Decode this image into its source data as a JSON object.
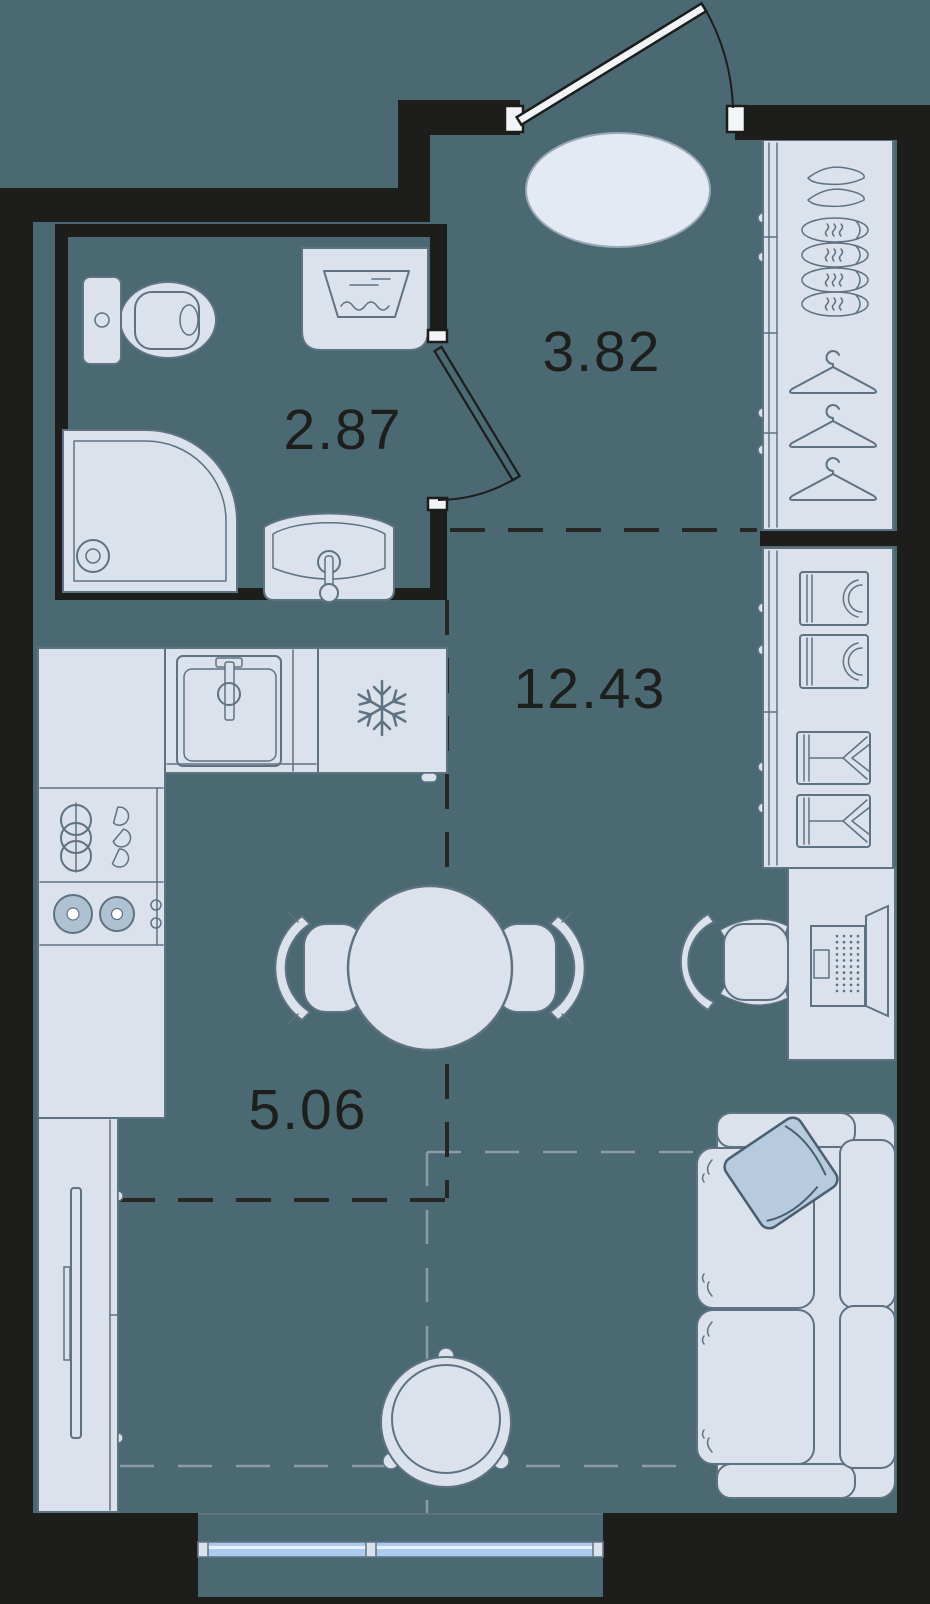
{
  "title": "Studio apartment floor plan",
  "rooms": [
    {
      "id": "bathroom",
      "area": "2.87"
    },
    {
      "id": "hallway",
      "area": "3.82"
    },
    {
      "id": "living-room",
      "area": "12.43"
    },
    {
      "id": "kitchen-living",
      "area": "5.06"
    }
  ],
  "furniture": {
    "bathroom": [
      "toilet",
      "washing-machine",
      "shower",
      "wash-basin"
    ],
    "hallway": [
      "entrance-door",
      "oval-rug",
      "shoe-wardrobe",
      "hanger-wardrobe"
    ],
    "living_room": [
      "linen-closet",
      "desk",
      "laptop",
      "office-chair",
      "sofa",
      "pillow",
      "lounge-chair"
    ],
    "kitchen": [
      "kitchen-sink",
      "fridge-snowflake",
      "dish-rack",
      "stove-two-burners",
      "dining-table",
      "dining-chairs",
      "tv-console",
      "tv",
      "window"
    ]
  },
  "colors": {
    "background": "#4A6972",
    "wall": "#1D1D1B",
    "furniture_fill": "#DBE2EB",
    "furniture_stroke": "#5F7282",
    "label": "#1E1E1C",
    "pillow_fill": "#B6CBDD",
    "pillow_stroke": "#4C5F70",
    "burner_fill": "#AEC2D3",
    "window_glass": "#ACCBEF",
    "window_stripe": "#E7F0FA",
    "rug_fill": "#E4EAF3",
    "rug_stroke": "#9AA8B5",
    "dash_dark": "#262624",
    "dash_grey": "#8C9BA7",
    "jamb": "#F2F5F8"
  }
}
